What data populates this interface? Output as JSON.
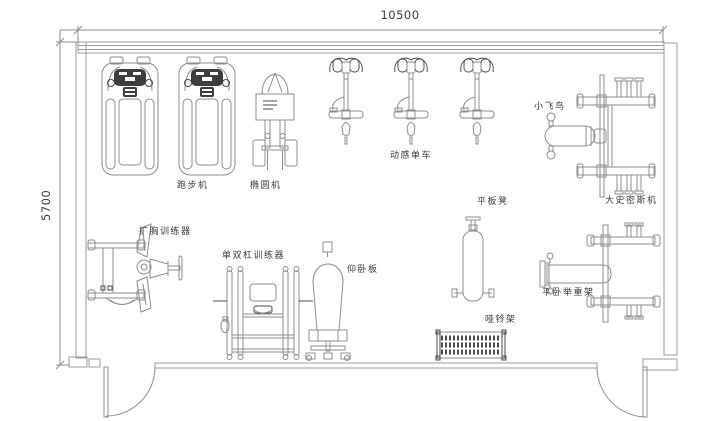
{
  "dimensions": {
    "width": "10500",
    "height": "5700"
  },
  "labels": {
    "treadmill": "跑步机",
    "elliptical": "椭圆机",
    "spin_bike": "动感单车",
    "fly_bird": "小飞鸟",
    "smith_machine": "大史密斯机",
    "pec_deck": "扩胸训练器",
    "dip_station": "单双杠训练器",
    "situp_board": "仰卧板",
    "flat_bench": "平板凳",
    "dumbbell_rack": "哑铃架",
    "bench_press": "平卧举重架"
  },
  "colors": {
    "background": "#ffffff",
    "wall": "#9a9a9a",
    "line": "#8c8c8c",
    "dark_line": "#4a4a4a",
    "console_fill": "#3d3d3d",
    "text": "#3a3a3a"
  }
}
